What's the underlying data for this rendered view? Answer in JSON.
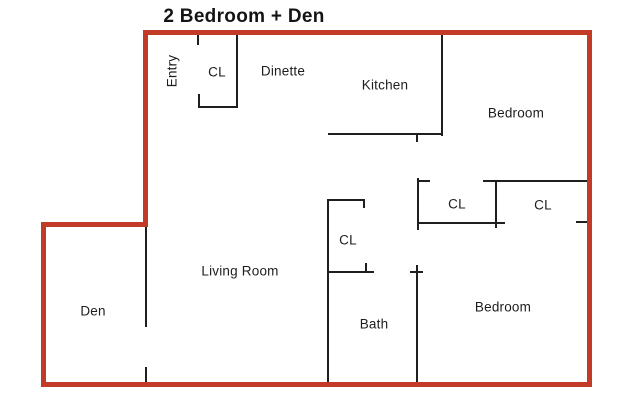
{
  "title": "2 Bedroom + Den",
  "diagram_type": "apartment-floorplan",
  "colors": {
    "outline": "#c23b27",
    "wall": "#1f1f1f",
    "background": "#ffffff",
    "text": "#1d1d1d"
  },
  "title_pos": {
    "x": 244,
    "y": 17
  },
  "rooms": [
    {
      "id": "entry",
      "label": "Entry",
      "x": 172,
      "y": 71,
      "rotated": true
    },
    {
      "id": "closet-entry",
      "label": "CL",
      "x": 217,
      "y": 72,
      "rotated": false
    },
    {
      "id": "dinette",
      "label": "Dinette",
      "x": 283,
      "y": 71,
      "rotated": false
    },
    {
      "id": "kitchen",
      "label": "Kitchen",
      "x": 385,
      "y": 85,
      "rotated": false
    },
    {
      "id": "bedroom-top",
      "label": "Bedroom",
      "x": 516,
      "y": 113,
      "rotated": false
    },
    {
      "id": "closet-hall-left",
      "label": "CL",
      "x": 457,
      "y": 204,
      "rotated": false
    },
    {
      "id": "closet-hall-right",
      "label": "CL",
      "x": 543,
      "y": 205,
      "rotated": false
    },
    {
      "id": "closet-bath",
      "label": "CL",
      "x": 348,
      "y": 240,
      "rotated": false
    },
    {
      "id": "living-room",
      "label": "Living Room",
      "x": 240,
      "y": 271,
      "rotated": false
    },
    {
      "id": "den",
      "label": "Den",
      "x": 93,
      "y": 311,
      "rotated": false
    },
    {
      "id": "bath",
      "label": "Bath",
      "x": 374,
      "y": 324,
      "rotated": false
    },
    {
      "id": "bedroom-bottom",
      "label": "Bedroom",
      "x": 503,
      "y": 307,
      "rotated": false
    }
  ],
  "outline_segments": [
    {
      "id": "outline-top",
      "x": 143,
      "y": 30,
      "w": 449,
      "h": 5
    },
    {
      "id": "outline-right",
      "x": 587,
      "y": 30,
      "w": 5,
      "h": 357
    },
    {
      "id": "outline-bottom",
      "x": 41,
      "y": 382,
      "w": 551,
      "h": 5
    },
    {
      "id": "outline-left-upper",
      "x": 143,
      "y": 30,
      "w": 5,
      "h": 197
    },
    {
      "id": "outline-den-top",
      "x": 41,
      "y": 222,
      "w": 107,
      "h": 5
    },
    {
      "id": "outline-left-lower",
      "x": 41,
      "y": 222,
      "w": 5,
      "h": 165
    }
  ],
  "wall_segments": [
    {
      "id": "entry-closet-top-tick",
      "x": 197,
      "y": 35,
      "w": 2,
      "h": 10
    },
    {
      "id": "entry-closet-left-jamb",
      "x": 198,
      "y": 94,
      "w": 2,
      "h": 14
    },
    {
      "id": "entry-closet-bottom",
      "x": 198,
      "y": 106,
      "w": 40,
      "h": 2
    },
    {
      "id": "entry-closet-right",
      "x": 236,
      "y": 35,
      "w": 2,
      "h": 73
    },
    {
      "id": "kitchen-right-wall",
      "x": 441,
      "y": 35,
      "w": 2,
      "h": 101
    },
    {
      "id": "kitchen-bottom-wall",
      "x": 328,
      "y": 133,
      "w": 115,
      "h": 2
    },
    {
      "id": "kitchen-door-jamb",
      "x": 416,
      "y": 135,
      "w": 2,
      "h": 7
    },
    {
      "id": "hall-closet-left-wall",
      "x": 417,
      "y": 178,
      "w": 2,
      "h": 52
    },
    {
      "id": "hall-closet-left-tick",
      "x": 417,
      "y": 180,
      "w": 13,
      "h": 2
    },
    {
      "id": "hall-closets-top-wall",
      "x": 483,
      "y": 180,
      "w": 104,
      "h": 2
    },
    {
      "id": "hall-closets-mid-wall",
      "x": 495,
      "y": 180,
      "w": 2,
      "h": 48
    },
    {
      "id": "hall-closets-bottom-wall",
      "x": 417,
      "y": 222,
      "w": 88,
      "h": 2
    },
    {
      "id": "hall-closet-right-tick",
      "x": 576,
      "y": 221,
      "w": 11,
      "h": 2
    },
    {
      "id": "living-bath-wall",
      "x": 327,
      "y": 199,
      "w": 2,
      "h": 183
    },
    {
      "id": "bath-closet-top",
      "x": 327,
      "y": 199,
      "w": 38,
      "h": 2
    },
    {
      "id": "bath-closet-top-jamb",
      "x": 363,
      "y": 199,
      "w": 2,
      "h": 9
    },
    {
      "id": "bath-closet-bottom",
      "x": 327,
      "y": 271,
      "w": 47,
      "h": 2
    },
    {
      "id": "bath-closet-bottom-jamb",
      "x": 365,
      "y": 263,
      "w": 2,
      "h": 9
    },
    {
      "id": "bath-right-wall",
      "x": 416,
      "y": 265,
      "w": 2,
      "h": 117
    },
    {
      "id": "bath-right-top-tick",
      "x": 410,
      "y": 271,
      "w": 13,
      "h": 2
    },
    {
      "id": "den-right-wall",
      "x": 145,
      "y": 227,
      "w": 2,
      "h": 100
    },
    {
      "id": "den-door-jamb",
      "x": 145,
      "y": 367,
      "w": 2,
      "h": 15
    }
  ]
}
